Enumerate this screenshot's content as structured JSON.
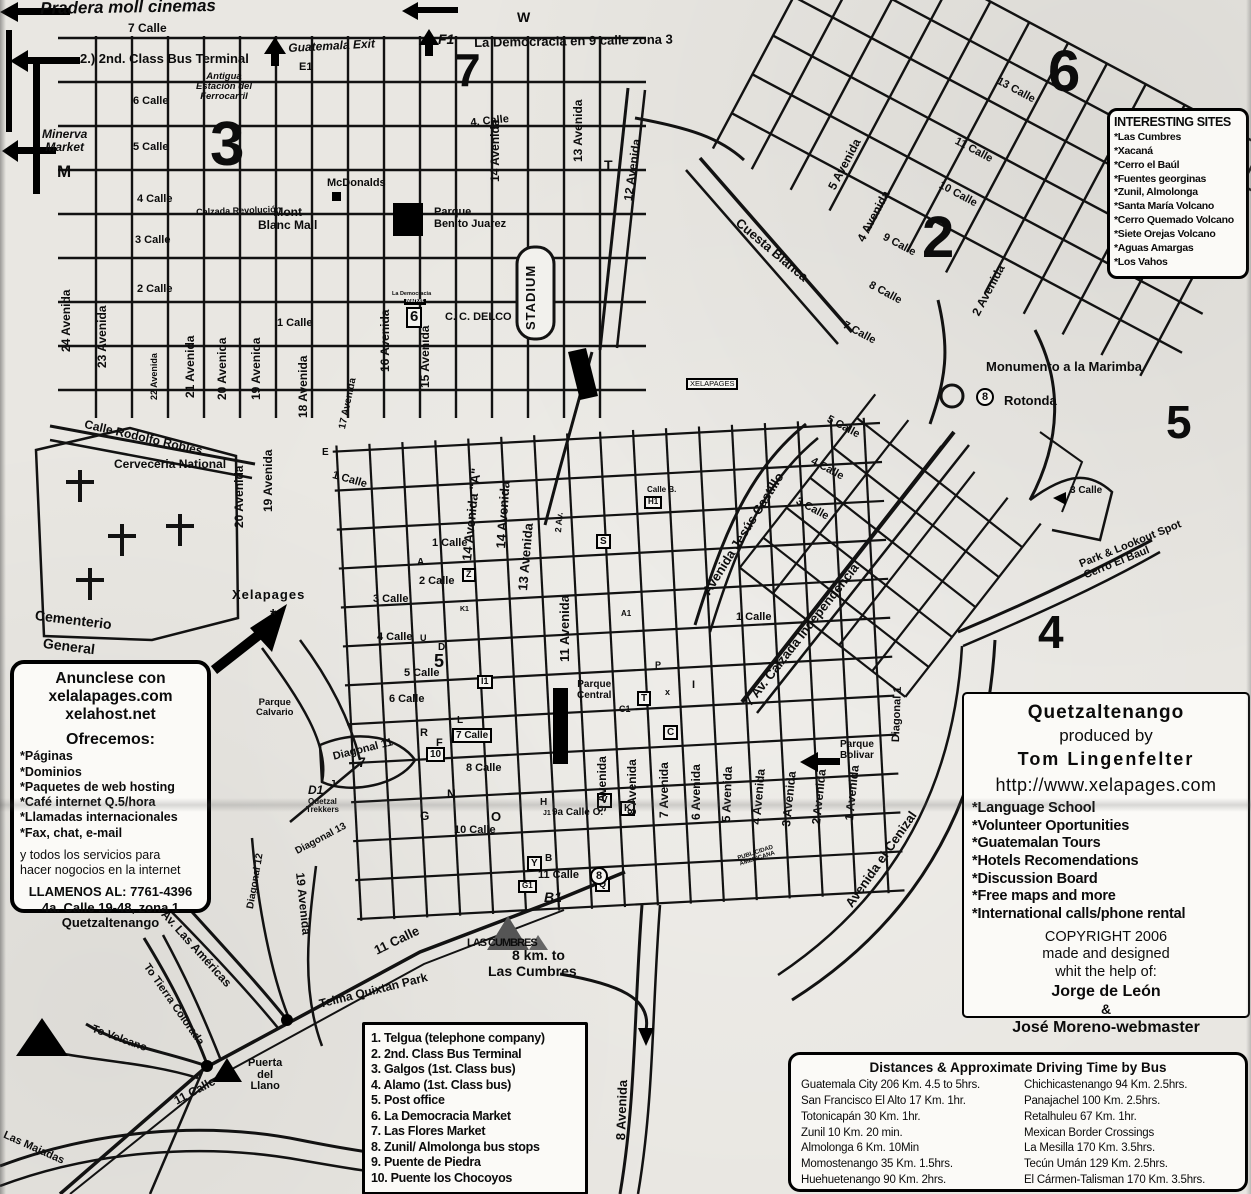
{
  "boxes": {
    "interesting_sites": {
      "title": "INTERESTING SITES",
      "items": [
        "*Las Cumbres",
        "*Xacaná",
        "*Cerro el Baúl",
        "*Fuentes georginas",
        "*Zunil, Almolonga",
        "*Santa María Volcano",
        "*Cerro Quemado Volcano",
        "*Siete Orejas Volcano",
        "*Aguas Amargas",
        "*Los Vahos"
      ]
    },
    "producer": {
      "title": "Quetzaltenango",
      "produced_by": "produced by",
      "author": "Tom Lingenfelter",
      "url": "http://www.xelapages.com",
      "features": [
        "*Language School",
        "*Volunteer Oportunities",
        "*Guatemalan Tours",
        "*Hotels Recomendations",
        "*Discussion Board",
        "*Free maps and more",
        "*International calls/phone rental"
      ],
      "copyright_lines": [
        "COPYRIGHT 2006",
        "made and designed",
        "whit the help of:"
      ],
      "credit1": "Jorge de León",
      "amp": "&",
      "credit2": "José Moreno-webmaster"
    },
    "ad": {
      "title_lines": "Anunclese con\nxelalapages.com\nxelahost.net",
      "offer_title": "Ofrecemos:",
      "offers": [
        "*Páginas",
        "*Dominios",
        "*Paquetes de web hosting",
        "*Café internet Q.5/hora",
        "*Llamadas internacionales",
        "*Fax, chat, e-mail"
      ],
      "tagline": "y todos los servicios para\nhacer nogocios en la internet",
      "contact": "LLAMENOS AL: 7761-4396\n4a. Calle 19-48, zona 1\nQuetzaltenango"
    },
    "legend": {
      "items": [
        "1. Telgua (telephone company)",
        "2. 2nd. Class Bus Terminal",
        "3. Galgos (1st. Class bus)",
        "4. Alamo (1st. Class bus)",
        "5. Post office",
        "6. La Democracia Market",
        "7. Las Flores Market",
        "8. Zunil/ Almolonga bus stops",
        "9. Puente de Piedra",
        "10. Puente los Chocoyos"
      ]
    },
    "distances": {
      "title": "Distances & Approximate Driving Time by Bus",
      "col1": [
        "Guatemala City 206 Km. 4.5 to 5hrs.",
        "San Francisco El Alto 17 Km. 1hr.",
        "Totonicapán 30 Km. 1hr.",
        "Zunil 10 Km. 20 min.",
        "Almolonga 6 Km. 10Min",
        "Momostenango 35 Km. 1.5hrs.",
        "Huehuetenango 90 Km. 2hrs."
      ],
      "col2": [
        "Chichicastenango 94 Km. 2.5hrs.",
        "Panajachel 100 Km. 2.5hrs.",
        "Retalhuleu 67 Km. 1hr.",
        "Mexican Border Crossings",
        "La Mesilla 170 Km. 3.5hrs.",
        "Tecún Umán 129 Km. 2.5hrs.",
        "El Cármen-Talisman 170 Km. 3.5hrs."
      ]
    }
  },
  "map_labels": [
    {
      "t": "Pradera moll cinemas",
      "x": 40,
      "y": 0,
      "s": 17,
      "i": 1,
      "r": -1
    },
    {
      "t": "7 Calle",
      "x": 128,
      "y": 22,
      "s": 12
    },
    {
      "t": "2.) 2nd. Class Bus Terminal",
      "x": 80,
      "y": 52,
      "s": 13
    },
    {
      "t": "Guatemala Exit",
      "x": 288,
      "y": 42,
      "s": 12,
      "i": 1,
      "r": -3
    },
    {
      "t": "E1",
      "x": 299,
      "y": 62,
      "s": 11
    },
    {
      "t": "Antigua\nEstación del\nFerrocarril",
      "x": 196,
      "y": 72,
      "s": 9.5,
      "i": 1,
      "al": 1
    },
    {
      "t": "W",
      "x": 517,
      "y": 10,
      "s": 14
    },
    {
      "t": "F1",
      "x": 438,
      "y": 32,
      "s": 14,
      "i": 1
    },
    {
      "t": "La Democracia en 9 calle zona 3",
      "x": 474,
      "y": 36,
      "s": 13,
      "r": -1
    },
    {
      "t": "Minerva\nMarket",
      "x": 42,
      "y": 128,
      "s": 12,
      "i": 1,
      "al": 1
    },
    {
      "t": "M",
      "x": 57,
      "y": 163,
      "s": 17
    },
    {
      "t": "6 Calle",
      "x": 133,
      "y": 96,
      "s": 11
    },
    {
      "t": "5 Calle",
      "x": 133,
      "y": 142,
      "s": 11
    },
    {
      "t": "4 Calle",
      "x": 137,
      "y": 194,
      "s": 11
    },
    {
      "t": "3 Calle",
      "x": 135,
      "y": 235,
      "s": 11
    },
    {
      "t": "2 Calle",
      "x": 137,
      "y": 284,
      "s": 11
    },
    {
      "t": "1 Calle",
      "x": 277,
      "y": 318,
      "s": 11
    },
    {
      "t": "McDonalds",
      "x": 327,
      "y": 178,
      "s": 11
    },
    {
      "t": "Calzada Revolución",
      "x": 196,
      "y": 208,
      "s": 9,
      "r": -2
    },
    {
      "t": "Mont\nBlanc Mall",
      "x": 258,
      "y": 206,
      "s": 12,
      "al": 1
    },
    {
      "t": "Parque\nBenito Juarez",
      "x": 434,
      "y": 207,
      "s": 11
    },
    {
      "t": "C. C. DELCO",
      "x": 445,
      "y": 312,
      "s": 11
    },
    {
      "t": "La Democracia",
      "x": 392,
      "y": 292,
      "s": 5.5
    },
    {
      "t": "Market",
      "x": 404,
      "y": 299,
      "s": 5.5,
      "inv": 1
    },
    {
      "t": "6",
      "x": 406,
      "y": 307,
      "s": 15,
      "bx": 1
    },
    {
      "t": "XELAPAGES",
      "x": 686,
      "y": 378,
      "s": 7.5,
      "n": 1,
      "bx": 1
    },
    {
      "t": "STADIUM",
      "x": 524,
      "y": 330,
      "s": 13,
      "r": -90,
      "ls": 1
    },
    {
      "t": "4. Calle",
      "x": 470,
      "y": 118,
      "s": 11,
      "r": -6
    },
    {
      "t": "3",
      "x": 210,
      "y": 112,
      "s": 62
    },
    {
      "t": "7",
      "x": 455,
      "y": 46,
      "s": 46
    },
    {
      "t": "6",
      "x": 1048,
      "y": 42,
      "s": 58
    },
    {
      "t": "2",
      "x": 922,
      "y": 208,
      "s": 58
    },
    {
      "t": "5",
      "x": 1166,
      "y": 398,
      "s": 46
    },
    {
      "t": "4",
      "x": 1038,
      "y": 608,
      "s": 46
    },
    {
      "t": "24 Avenida",
      "x": 60,
      "y": 352,
      "s": 12,
      "r": -90
    },
    {
      "t": "23 Avenida",
      "x": 96,
      "y": 368,
      "s": 12,
      "r": -90
    },
    {
      "t": "22 Avenida",
      "x": 150,
      "y": 400,
      "s": 9,
      "r": -90
    },
    {
      "t": "21 Avenida",
      "x": 184,
      "y": 398,
      "s": 12,
      "r": -90
    },
    {
      "t": "20 Avenida",
      "x": 216,
      "y": 400,
      "s": 12,
      "r": -90
    },
    {
      "t": "19 Avenida",
      "x": 250,
      "y": 400,
      "s": 12,
      "r": -90
    },
    {
      "t": "18 Avenida",
      "x": 297,
      "y": 418,
      "s": 12,
      "r": -90
    },
    {
      "t": "17 Avenida",
      "x": 338,
      "y": 428,
      "s": 10,
      "r": -78
    },
    {
      "t": "16 Avenida",
      "x": 379,
      "y": 372,
      "s": 12,
      "r": -90
    },
    {
      "t": "15 Avenida",
      "x": 419,
      "y": 388,
      "s": 12,
      "r": -90
    },
    {
      "t": "14 Avenida",
      "x": 489,
      "y": 182,
      "s": 12,
      "r": -90
    },
    {
      "t": "13 Avenida",
      "x": 572,
      "y": 162,
      "s": 12,
      "r": -90
    },
    {
      "t": "12 Avenida",
      "x": 622,
      "y": 200,
      "s": 12,
      "r": -82
    },
    {
      "t": "T",
      "x": 604,
      "y": 158,
      "s": 14
    },
    {
      "t": "13 Calle",
      "x": 1000,
      "y": 76,
      "s": 11,
      "r": 28
    },
    {
      "t": "11 Calle",
      "x": 958,
      "y": 136,
      "s": 11,
      "r": 28
    },
    {
      "t": "10 Calle",
      "x": 942,
      "y": 180,
      "s": 11,
      "r": 28
    },
    {
      "t": "9 Calle",
      "x": 886,
      "y": 232,
      "s": 11,
      "r": 28
    },
    {
      "t": "8 Calle",
      "x": 872,
      "y": 280,
      "s": 11,
      "r": 28
    },
    {
      "t": "7 Calle",
      "x": 846,
      "y": 320,
      "s": 11,
      "r": 28
    },
    {
      "t": "5 Avenida",
      "x": 826,
      "y": 186,
      "s": 12,
      "r": -62
    },
    {
      "t": "4 Avenida",
      "x": 855,
      "y": 238,
      "s": 12,
      "r": -62
    },
    {
      "t": "2 Avenida",
      "x": 970,
      "y": 312,
      "s": 12,
      "r": -62
    },
    {
      "t": "Cuesta Blanca",
      "x": 742,
      "y": 216,
      "s": 13,
      "r": 40
    },
    {
      "t": "Monumento a la Marimba",
      "x": 986,
      "y": 360,
      "s": 13
    },
    {
      "t": "8",
      "x": 976,
      "y": 388,
      "s": 11,
      "ci": 1
    },
    {
      "t": "Rotonda",
      "x": 1004,
      "y": 394,
      "s": 13
    },
    {
      "t": "Calle Rodolfo Robles",
      "x": 86,
      "y": 418,
      "s": 12,
      "r": 13
    },
    {
      "t": "Cerveceria National",
      "x": 114,
      "y": 458,
      "s": 12
    },
    {
      "t": "20 Avenida",
      "x": 233,
      "y": 528,
      "s": 12,
      "r": -90
    },
    {
      "t": "19 Avenida",
      "x": 262,
      "y": 512,
      "s": 12,
      "r": -90
    },
    {
      "t": "Cementerio",
      "x": 36,
      "y": 608,
      "s": 14,
      "r": 7
    },
    {
      "t": "General",
      "x": 44,
      "y": 636,
      "s": 14,
      "r": 7
    },
    {
      "t": "Xelapages",
      "x": 232,
      "y": 588,
      "s": 13,
      "ls": 1
    },
    {
      "t": "*",
      "x": 270,
      "y": 608,
      "s": 16
    },
    {
      "t": "Parque\nCalvario",
      "x": 256,
      "y": 698,
      "s": 9.5,
      "al": 1
    },
    {
      "t": "E",
      "x": 322,
      "y": 448,
      "s": 10
    },
    {
      "t": "1 Calle",
      "x": 334,
      "y": 470,
      "s": 11,
      "r": 16
    },
    {
      "t": "1 Calle",
      "x": 432,
      "y": 538,
      "s": 11
    },
    {
      "t": "A",
      "x": 417,
      "y": 558,
      "s": 10
    },
    {
      "t": "2 Calle",
      "x": 419,
      "y": 576,
      "s": 11
    },
    {
      "t": "3 Calle",
      "x": 373,
      "y": 594,
      "s": 11
    },
    {
      "t": "4 Calle",
      "x": 377,
      "y": 632,
      "s": 11
    },
    {
      "t": "5 Calle",
      "x": 404,
      "y": 668,
      "s": 11
    },
    {
      "t": "6 Calle",
      "x": 389,
      "y": 694,
      "s": 11
    },
    {
      "t": "7 Calle",
      "x": 452,
      "y": 728,
      "s": 10,
      "bx": 1
    },
    {
      "t": "8 Calle",
      "x": 466,
      "y": 763,
      "s": 11
    },
    {
      "t": "Z",
      "x": 462,
      "y": 568,
      "s": 9,
      "bx": 1
    },
    {
      "t": "K1",
      "x": 460,
      "y": 606,
      "s": 7
    },
    {
      "t": "U",
      "x": 420,
      "y": 634,
      "s": 9
    },
    {
      "t": "D",
      "x": 438,
      "y": 643,
      "s": 10
    },
    {
      "t": "5",
      "x": 434,
      "y": 652,
      "s": 18
    },
    {
      "t": "I1",
      "x": 477,
      "y": 675,
      "s": 9,
      "bx": 1
    },
    {
      "t": "L",
      "x": 457,
      "y": 716,
      "s": 10
    },
    {
      "t": "R",
      "x": 420,
      "y": 728,
      "s": 11
    },
    {
      "t": "F",
      "x": 436,
      "y": 738,
      "s": 11
    },
    {
      "t": "10",
      "x": 426,
      "y": 747,
      "s": 10,
      "bx": 1
    },
    {
      "t": "14 Avenida \"A\"",
      "x": 460,
      "y": 560,
      "s": 13,
      "r": -84
    },
    {
      "t": "14 Avenida",
      "x": 494,
      "y": 548,
      "s": 13,
      "r": -86
    },
    {
      "t": "13 Avenida",
      "x": 516,
      "y": 590,
      "s": 13,
      "r": -85
    },
    {
      "t": "2 Av.",
      "x": 554,
      "y": 532,
      "s": 9,
      "r": -85
    },
    {
      "t": "Calle B.",
      "x": 647,
      "y": 486,
      "s": 8
    },
    {
      "t": "H1",
      "x": 644,
      "y": 496,
      "s": 8,
      "bx": 1
    },
    {
      "t": "S",
      "x": 596,
      "y": 534,
      "s": 10,
      "bx": 1
    },
    {
      "t": "A1",
      "x": 621,
      "y": 610,
      "s": 8
    },
    {
      "t": "P",
      "x": 655,
      "y": 661,
      "s": 9
    },
    {
      "t": "C1",
      "x": 619,
      "y": 705,
      "s": 9
    },
    {
      "t": "11 Avenida",
      "x": 558,
      "y": 662,
      "s": 13,
      "r": -90
    },
    {
      "t": "Parque\nCentral",
      "x": 577,
      "y": 680,
      "s": 10,
      "al": 1
    },
    {
      "t": "T",
      "x": 637,
      "y": 691,
      "s": 10,
      "bx": 1
    },
    {
      "t": "x",
      "x": 665,
      "y": 688,
      "s": 9
    },
    {
      "t": "I",
      "x": 692,
      "y": 680,
      "s": 11
    },
    {
      "t": "C",
      "x": 663,
      "y": 725,
      "s": 10,
      "bx": 1
    },
    {
      "t": "V",
      "x": 597,
      "y": 793,
      "s": 10,
      "bx": 1
    },
    {
      "t": "K",
      "x": 620,
      "y": 801,
      "s": 10,
      "bx": 1
    },
    {
      "t": "Y",
      "x": 527,
      "y": 856,
      "s": 10,
      "bx": 1
    },
    {
      "t": "G1",
      "x": 518,
      "y": 880,
      "s": 8,
      "bx": 1
    },
    {
      "t": "Q",
      "x": 595,
      "y": 878,
      "s": 9,
      "bx": 1
    },
    {
      "t": "9 Avenida",
      "x": 596,
      "y": 812,
      "s": 12,
      "r": -90
    },
    {
      "t": "8 Avenida",
      "x": 626,
      "y": 815,
      "s": 12,
      "r": -90
    },
    {
      "t": "7 Avenida",
      "x": 658,
      "y": 818,
      "s": 12,
      "r": -90
    },
    {
      "t": "6 Avenida",
      "x": 690,
      "y": 820,
      "s": 12,
      "r": -90
    },
    {
      "t": "5 Avenida",
      "x": 720,
      "y": 822,
      "s": 12,
      "r": -88
    },
    {
      "t": "4 Avenida",
      "x": 750,
      "y": 824,
      "s": 12,
      "r": -85
    },
    {
      "t": "3 Avenida",
      "x": 780,
      "y": 826,
      "s": 12,
      "r": -84
    },
    {
      "t": "2 Avenida",
      "x": 810,
      "y": 824,
      "s": 12,
      "r": -84
    },
    {
      "t": "1 Avenida",
      "x": 843,
      "y": 820,
      "s": 12,
      "r": -84
    },
    {
      "t": "9a Calle O.",
      "x": 552,
      "y": 808,
      "s": 10
    },
    {
      "t": "H",
      "x": 540,
      "y": 798,
      "s": 10
    },
    {
      "t": "J1",
      "x": 543,
      "y": 810,
      "s": 7
    },
    {
      "t": "10 Calle",
      "x": 454,
      "y": 825,
      "s": 11
    },
    {
      "t": "N",
      "x": 447,
      "y": 788,
      "s": 12
    },
    {
      "t": "G",
      "x": 420,
      "y": 810,
      "s": 12
    },
    {
      "t": "O",
      "x": 491,
      "y": 810,
      "s": 13
    },
    {
      "t": "B",
      "x": 545,
      "y": 854,
      "s": 10
    },
    {
      "t": "11 Calle",
      "x": 538,
      "y": 870,
      "s": 11
    },
    {
      "t": "8",
      "x": 590,
      "y": 867,
      "s": 11,
      "ci": 1
    },
    {
      "t": "PUBLICIDAD\nAMERICANA",
      "x": 737,
      "y": 856,
      "s": 6,
      "r": -18,
      "al": 1
    },
    {
      "t": "Diagonal 1",
      "x": 891,
      "y": 742,
      "s": 11,
      "r": -88
    },
    {
      "t": "Parque\nBolivar",
      "x": 840,
      "y": 740,
      "s": 10,
      "al": 1
    },
    {
      "t": "Avenida el Cenizal",
      "x": 843,
      "y": 902,
      "s": 13,
      "r": -55
    },
    {
      "t": "Avenida Jesús Castillo",
      "x": 700,
      "y": 590,
      "s": 13,
      "r": -58
    },
    {
      "t": "7 Av. Calzada Independencia",
      "x": 742,
      "y": 700,
      "s": 13,
      "r": -52
    },
    {
      "t": "1 Calle",
      "x": 736,
      "y": 612,
      "s": 11
    },
    {
      "t": "5 Calle",
      "x": 830,
      "y": 414,
      "s": 11,
      "r": 28
    },
    {
      "t": "4 Calle",
      "x": 814,
      "y": 456,
      "s": 11,
      "r": 28
    },
    {
      "t": "3 Calle",
      "x": 799,
      "y": 496,
      "s": 11,
      "r": 28
    },
    {
      "t": "3 Calle",
      "x": 1070,
      "y": 486,
      "s": 10
    },
    {
      "t": "Park & Lookout Spot\nCerro El Baul",
      "x": 1078,
      "y": 560,
      "s": 11,
      "r": -22
    },
    {
      "t": "Diagonal 11",
      "x": 332,
      "y": 752,
      "s": 11,
      "r": -14
    },
    {
      "t": "7",
      "x": 358,
      "y": 755,
      "s": 14
    },
    {
      "t": "D1",
      "x": 308,
      "y": 784,
      "s": 12,
      "i": 1
    },
    {
      "t": "J",
      "x": 330,
      "y": 780,
      "s": 10
    },
    {
      "t": "Quetzal\nTrekkers",
      "x": 306,
      "y": 798,
      "s": 8,
      "al": 1
    },
    {
      "t": "Diagonal 13",
      "x": 294,
      "y": 848,
      "s": 10,
      "r": -28
    },
    {
      "t": "Diagonal 12",
      "x": 246,
      "y": 908,
      "s": 10,
      "r": -80
    },
    {
      "t": "19 Avenida",
      "x": 306,
      "y": 872,
      "s": 12,
      "r": 84
    },
    {
      "t": "11 Calle",
      "x": 372,
      "y": 945,
      "s": 13,
      "r": -26
    },
    {
      "t": "Telma Quixtan Park",
      "x": 318,
      "y": 998,
      "s": 12,
      "r": -14
    },
    {
      "t": "B1",
      "x": 544,
      "y": 890,
      "s": 14,
      "i": 1
    },
    {
      "t": "LAS CUMBRES",
      "x": 467,
      "y": 938,
      "s": 11,
      "ls": -1
    },
    {
      "t": "8 km. to",
      "x": 512,
      "y": 948,
      "s": 14
    },
    {
      "t": "Las Cumbres",
      "x": 488,
      "y": 964,
      "s": 14
    },
    {
      "t": "Av. Las Américas",
      "x": 168,
      "y": 908,
      "s": 12,
      "r": 48
    },
    {
      "t": "To Tierra Colorada",
      "x": 150,
      "y": 962,
      "s": 11,
      "r": 55
    },
    {
      "t": "To Volcano",
      "x": 94,
      "y": 1024,
      "s": 11,
      "r": 20
    },
    {
      "t": "Puerta\ndel\nLlano",
      "x": 248,
      "y": 1058,
      "s": 11,
      "al": 1
    },
    {
      "t": "11 Calle",
      "x": 172,
      "y": 1096,
      "s": 12,
      "r": -28
    },
    {
      "t": "Las Majadas",
      "x": 6,
      "y": 1130,
      "s": 11,
      "r": 24
    },
    {
      "t": "8 Avenida",
      "x": 614,
      "y": 1140,
      "s": 13,
      "r": -88
    }
  ]
}
